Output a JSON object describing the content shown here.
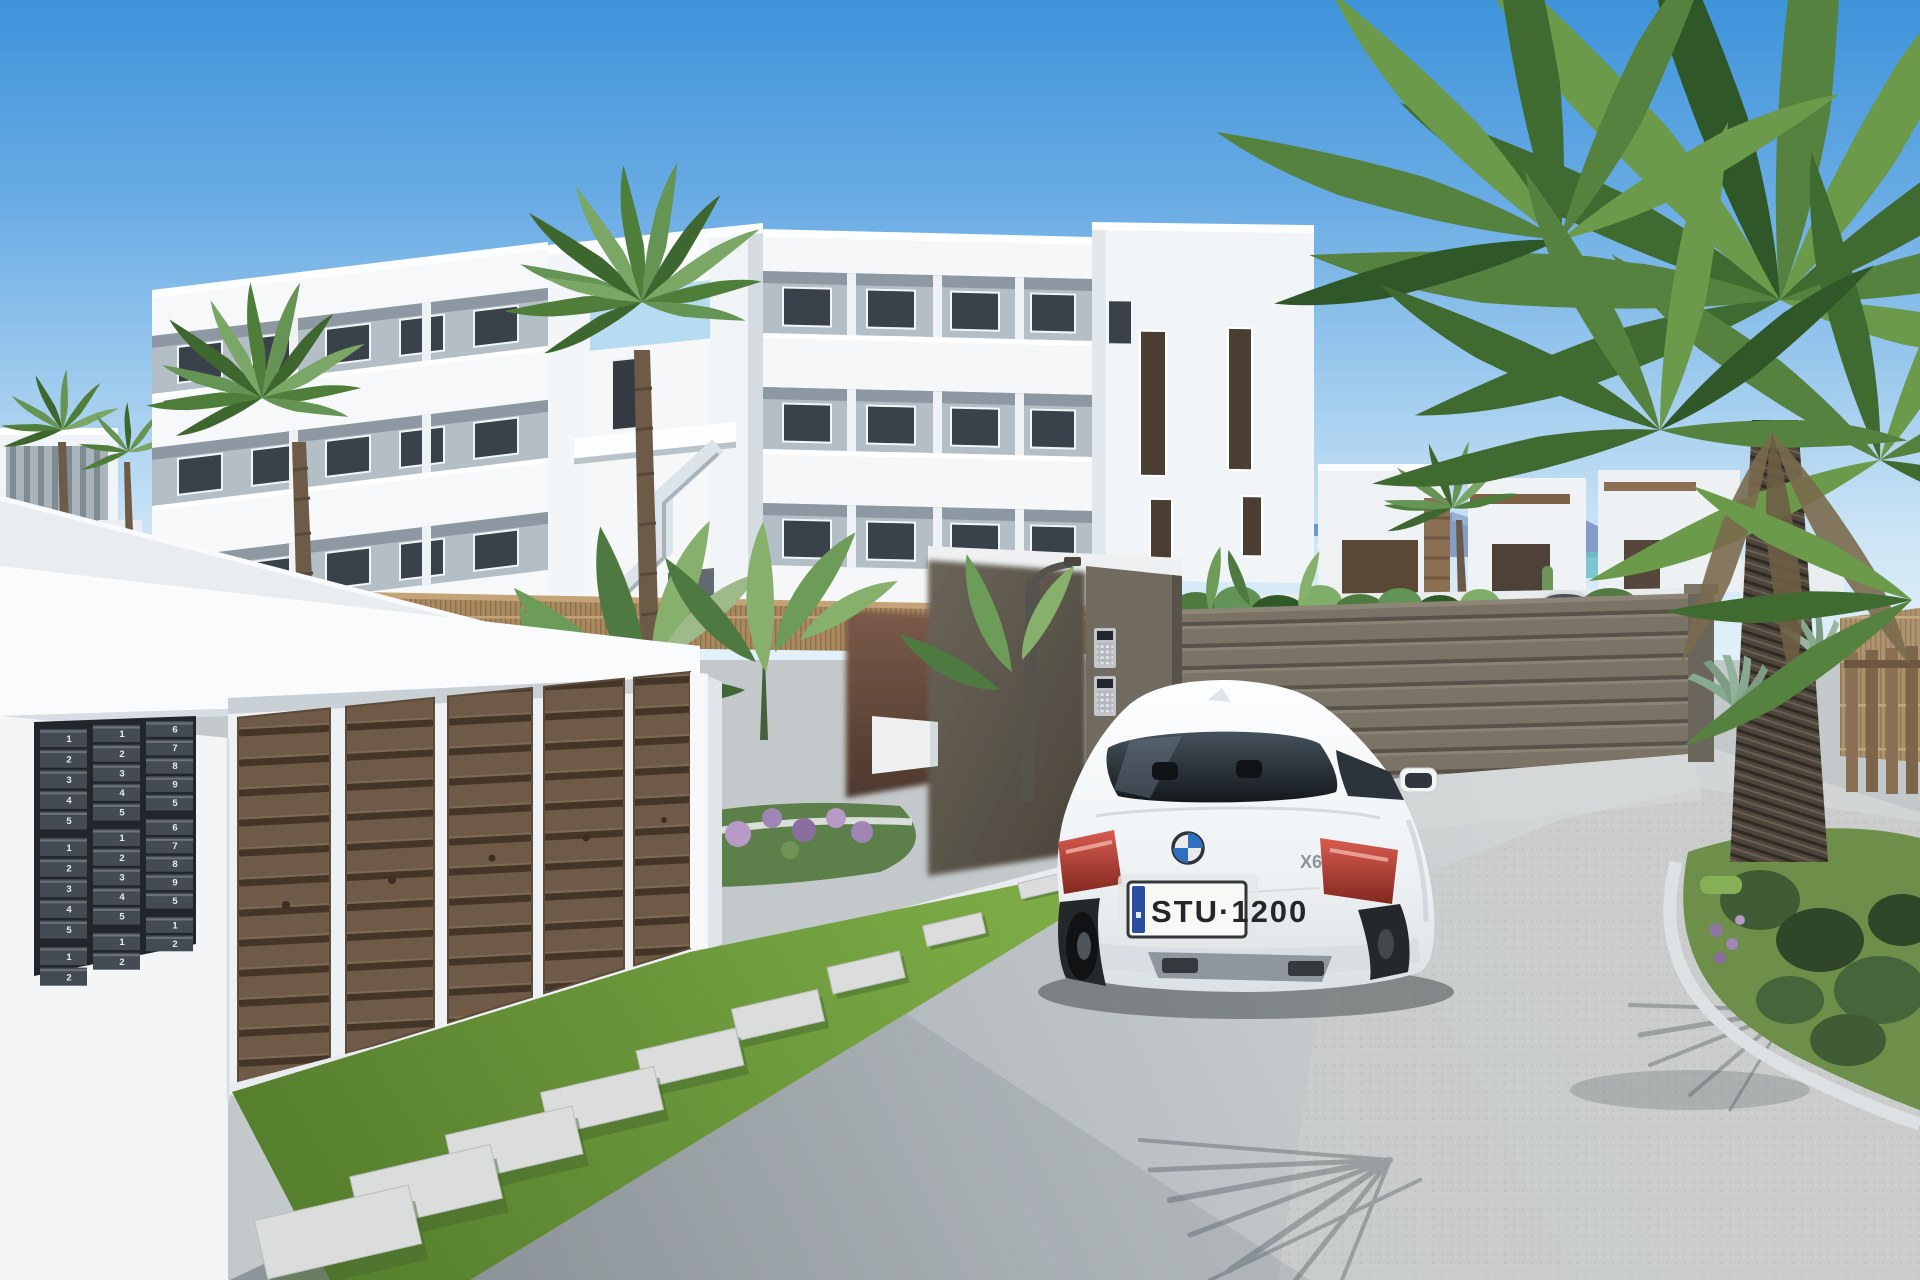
{
  "scene": {
    "title": "Residential complex entrance render",
    "description": "Sunny 3D render: white three-storey apartment block with external stair tower, reed-fenced garden, row of brown garage doors with mailbox bank, gated driveway with white BMW X6 arriving, silver coupe beyond the gate, palm trees and Mediterranean planting"
  },
  "palette": {
    "sky_top": "#3e93da",
    "sky_horizon": "#e9f4fa",
    "building_white": "#f6f8f9",
    "building_shade": "#dde3e8",
    "balcony_interior": "#b3bec7",
    "reed_fence": "#a98a5f",
    "entry_wall": "#6e4f41",
    "gate": "#7b7466",
    "gate_dark_leaf": "#5f594e",
    "garage_door": "#6e5a46",
    "mailbox_unit": "#454b52",
    "road": "#b6bcc0",
    "gravel": "#c9ccca",
    "grass": "#72a13f",
    "palm_green": "#55823f",
    "mountain_blue": "#8099c5",
    "sea_teal": "#6fc0ca",
    "car_white": "#f4f6f7",
    "taillight_red": "#b0453d",
    "plate_blue_strip": "#2b4fa0",
    "silver_car": "#c0c6cb",
    "stone_path": "#dadddc",
    "lamp_post": "#55534e"
  },
  "car": {
    "brand": "BMW",
    "model_badge": "X6",
    "license_plate": "STU·1200",
    "color": "white",
    "view": "rear"
  },
  "distant_car": {
    "color": "silver",
    "view": "rear"
  },
  "gate": {
    "intercom_keypads": 2
  },
  "garage": {
    "door_count": 5
  },
  "walkway": {
    "stepping_stones": 9
  },
  "mailboxes": {
    "columns": [
      {
        "numbers": [
          "1",
          "2",
          "3",
          "4",
          "5",
          "1",
          "2",
          "3",
          "4",
          "5",
          "1",
          "2"
        ]
      },
      {
        "numbers": [
          "1",
          "2",
          "3",
          "4",
          "5",
          "1",
          "2",
          "3",
          "4",
          "5",
          "1",
          "2"
        ]
      },
      {
        "numbers": [
          "6",
          "7",
          "8",
          "9",
          "5",
          "6",
          "7",
          "8",
          "9",
          "5",
          "1",
          "2"
        ]
      }
    ]
  }
}
